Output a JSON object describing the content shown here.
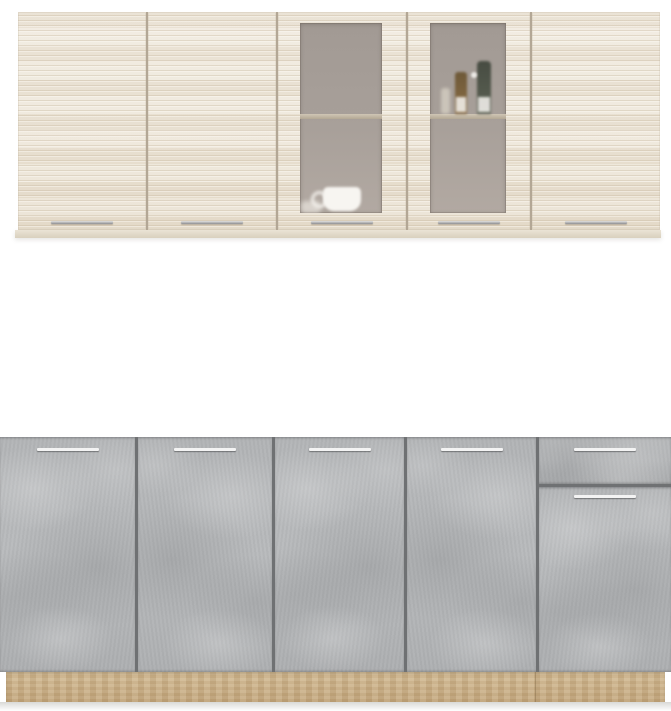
{
  "scene": {
    "subject": "kitchen-cabinet-set-product-photo",
    "wall_units_finish": "cream-wood-grain",
    "base_units_finish": "gray-concrete",
    "plinth_finish": "oak"
  },
  "colors": {
    "background": "#ffffff",
    "upper_door_base": "#ece5d8",
    "upper_door_stripe": "#cdbc9f",
    "upper_gap": "#b3a795",
    "glass": "#a29a94",
    "glass_light": "#b2a9a2",
    "glass_shelf": "#d4cab8",
    "lower_door_base": "#b5b7b9",
    "lower_gap": "#6f7173",
    "handle_metal": "#f3f3f3",
    "plinth_oak": "#d1b992"
  },
  "upper_cabinets": {
    "doors": [
      {
        "kind": "solid",
        "width": 128,
        "handle": "bar"
      },
      {
        "kind": "solid",
        "width": 128,
        "handle": "bar"
      },
      {
        "kind": "glass",
        "width": 128,
        "handle": "bar",
        "contents": "white-cups"
      },
      {
        "kind": "glass",
        "width": 122,
        "handle": "bar",
        "contents": "bottles"
      },
      {
        "kind": "solid",
        "width": 128,
        "handle": "bar"
      }
    ]
  },
  "lower_cabinets": {
    "sections": [
      {
        "kind": "door",
        "width": 135,
        "handle": "bar"
      },
      {
        "kind": "door",
        "width": 134,
        "handle": "bar"
      },
      {
        "kind": "door",
        "width": 129,
        "handle": "bar"
      },
      {
        "kind": "door",
        "width": 129,
        "handle": "bar"
      },
      {
        "kind": "drawer-over-door",
        "width": 132,
        "handle": "bar"
      }
    ]
  },
  "plinth": {
    "material": "oak",
    "seam": true
  }
}
